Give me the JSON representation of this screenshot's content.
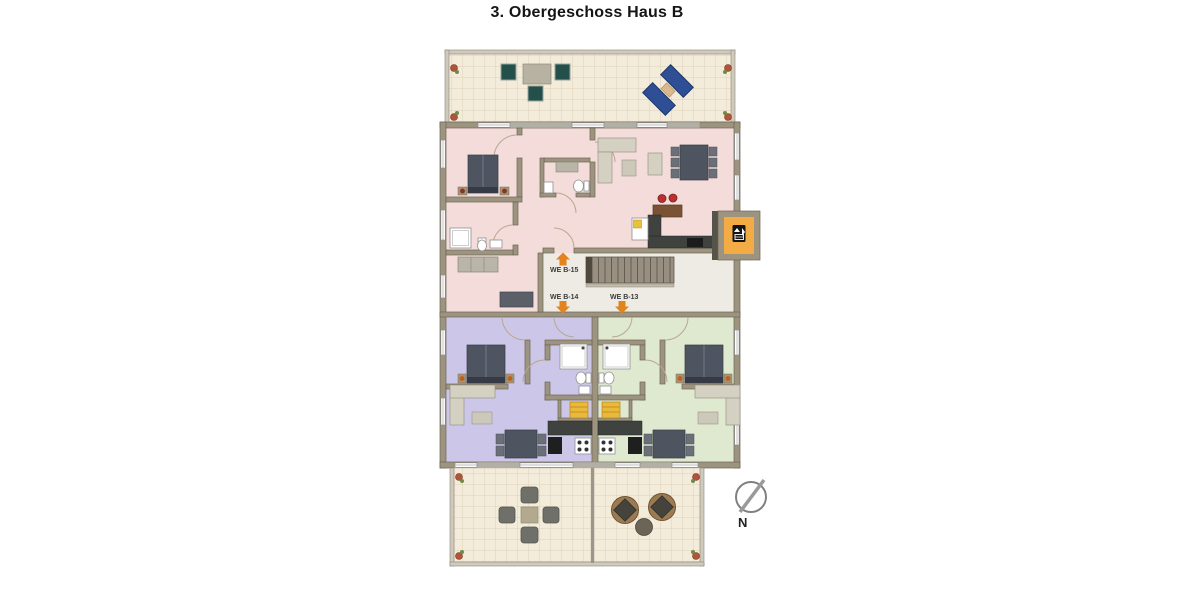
{
  "page_title": "3. Obergeschoss Haus B",
  "plan": {
    "units": [
      {
        "label": "WE B-15",
        "floor_color": "#f3dcda",
        "arrow": "up"
      },
      {
        "label": "WE B-14",
        "floor_color": "#ccc7e8",
        "arrow": "down"
      },
      {
        "label": "WE B-13",
        "floor_color": "#dfe9d0",
        "arrow": "down"
      }
    ],
    "compass_label": "N",
    "icons": {
      "elevator_icon": "elevator-up-down-arrows",
      "compass_icon": "north-needle",
      "stairs_icon": "staircase-treads"
    },
    "colors": {
      "unit_entry_arrow": "#e2831e",
      "elevator_cab": "#f2ab45",
      "walls": "#9d9480",
      "hall_floor": "#edebe3",
      "terrace_tile": "#f4ecdb"
    }
  }
}
